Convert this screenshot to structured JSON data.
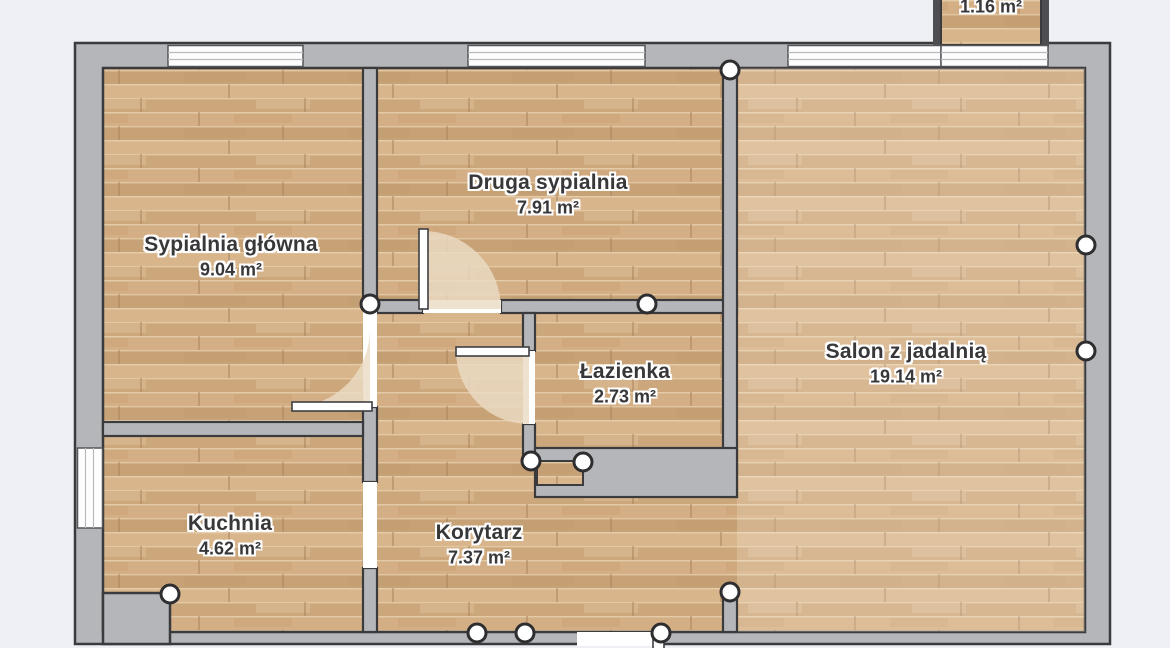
{
  "plan": {
    "rooms": {
      "master_bedroom": {
        "name": "Sypialnia główna",
        "area": "9.04 m²"
      },
      "second_bedroom": {
        "name": "Druga sypialnia",
        "area": "7.91 m²"
      },
      "bathroom": {
        "name": "Łazienka",
        "area": "2.73 m²"
      },
      "living_room": {
        "name": "Salon z jadalnią",
        "area": "19.14 m²"
      },
      "kitchen": {
        "name": "Kuchnia",
        "area": "4.62 m²"
      },
      "corridor": {
        "name": "Korytarz",
        "area": "7.37 m²"
      },
      "balcony": {
        "area": "1.16 m²"
      }
    },
    "colors": {
      "background": "#eef0f5",
      "wall_fill": "#b5b6b9",
      "wall_outline": "#3b3b3d",
      "floor_base": "#cfa97e",
      "door_swing": "#eadcc4",
      "window_fill": "#fdfdfd",
      "node_marker": "#ffffff"
    }
  }
}
